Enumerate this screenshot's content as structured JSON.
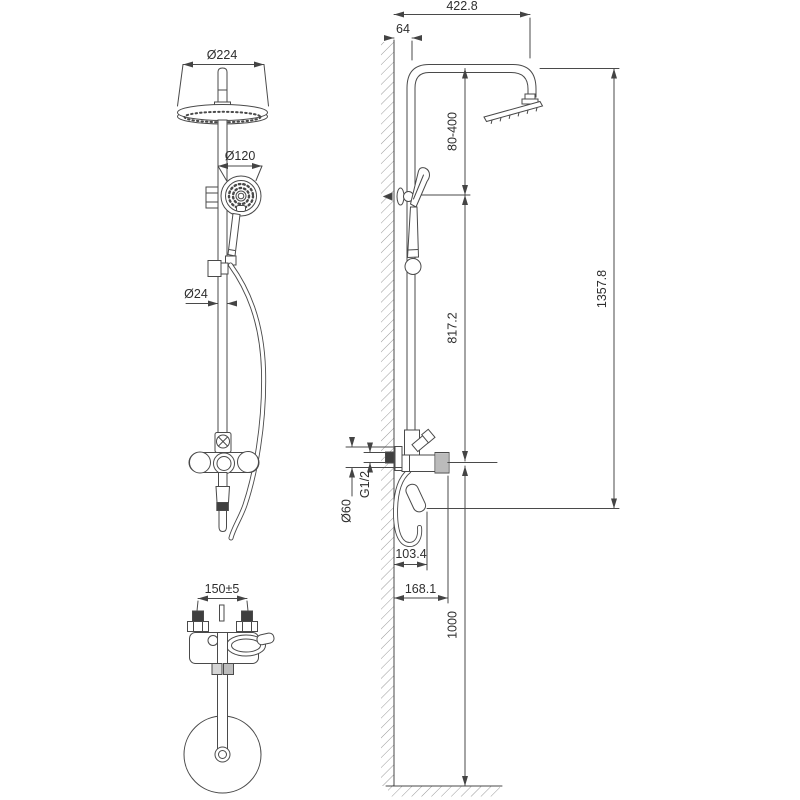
{
  "front_view": {
    "head_diameter": "Ø224",
    "hand_shower_diameter": "Ø120",
    "pipe_diameter": "Ø24",
    "connection_spacing": "150±5"
  },
  "side_view": {
    "horizontal_reach": "422.8",
    "wall_to_pipe": "64",
    "holder_adjust_range": "80-400",
    "bar_section_height": "817.2",
    "total_height": "1357.8",
    "mixer_to_floor": "1000",
    "escutcheon_diameter": "Ø60",
    "thread_size": "G1/2",
    "spout_reach": "103.4",
    "handle_reach": "168.1"
  }
}
